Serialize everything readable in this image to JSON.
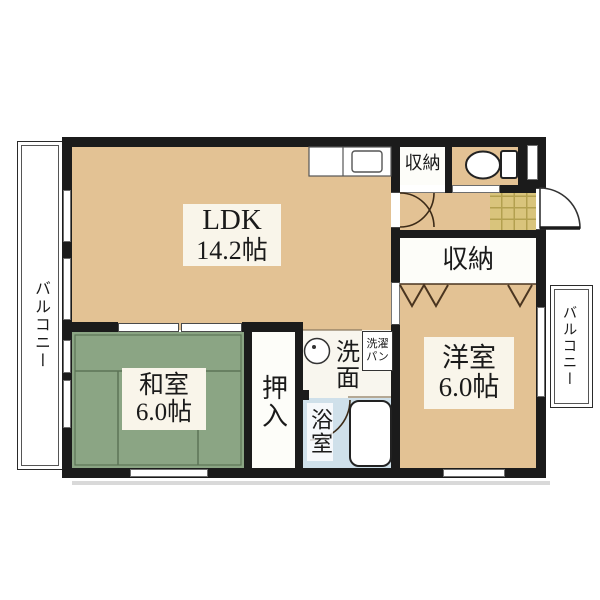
{
  "floor_plan": {
    "rooms": {
      "ldk": {
        "name": "LDK",
        "size": "14.2帖"
      },
      "japanese_room": {
        "name": "和室",
        "size": "6.0帖"
      },
      "western_room": {
        "name": "洋室",
        "size": "6.0帖"
      },
      "storage_upper": {
        "name": "収納"
      },
      "storage_hall": {
        "name": "収納"
      },
      "closet": {
        "name": "押入"
      },
      "washroom": {
        "name": "洗面"
      },
      "laundry_pan": {
        "line1": "洗濯",
        "line2": "パン"
      },
      "bathroom": {
        "name": "浴室"
      },
      "balcony_left": {
        "name": "バルコニー"
      },
      "balcony_right": {
        "name": "バルコニー"
      }
    },
    "colors": {
      "wall": "#1b1b1b",
      "wood_floor": "#e3c294",
      "tatami": "#8ba584",
      "bathroom": "#cfe0ea",
      "entrance_tile": "#d9c47c",
      "label_background": "#f9f5ea"
    }
  }
}
